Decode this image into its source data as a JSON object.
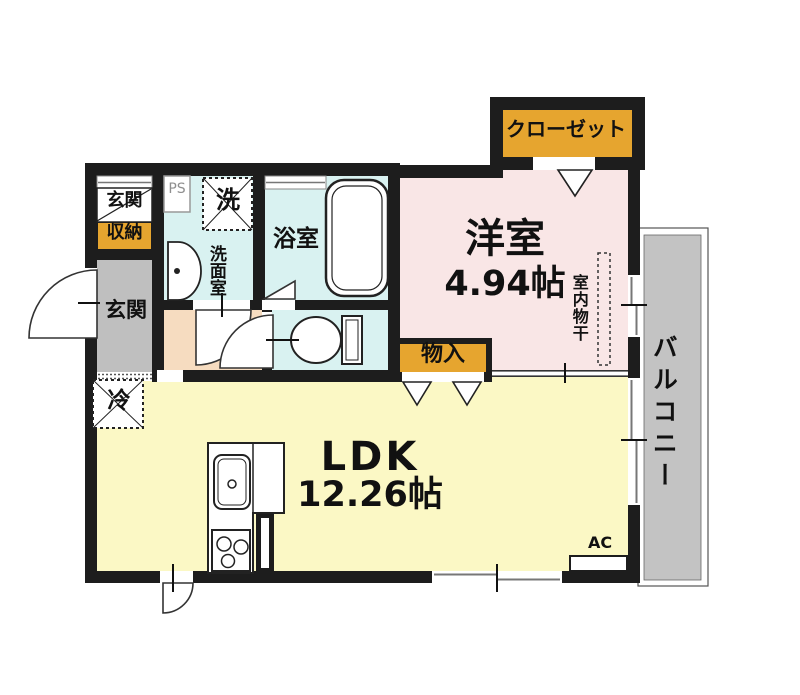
{
  "labels": {
    "closet": "クローゼット",
    "western_room": "洋室",
    "western_room_size": "4.94帖",
    "indoor_clothes_drying": "室内物干",
    "balcony": "バルコニー",
    "storage": "物入",
    "ldk": "LDK",
    "ldk_size": "12.26帖",
    "air_conditioner": "AC",
    "refrigerator": "冷",
    "bathroom": "浴室",
    "washroom": "洗面室",
    "washing_machine": "洗",
    "pipe_space": "PS",
    "entrance_storage_line1": "玄関",
    "entrance_storage_line2": "収納",
    "entrance": "玄関"
  },
  "colors": {
    "wall": "#1d1d1d",
    "western_room_floor": "#f9e6e6",
    "ldk_floor": "#fbf8c5",
    "wet_area_floor": "#d9f2f1",
    "hallway_floor": "#f6dcc0",
    "entrance_floor": "#bfbfbf",
    "balcony_floor": "#c3c3c3",
    "accent_label": "#e6a52f"
  }
}
